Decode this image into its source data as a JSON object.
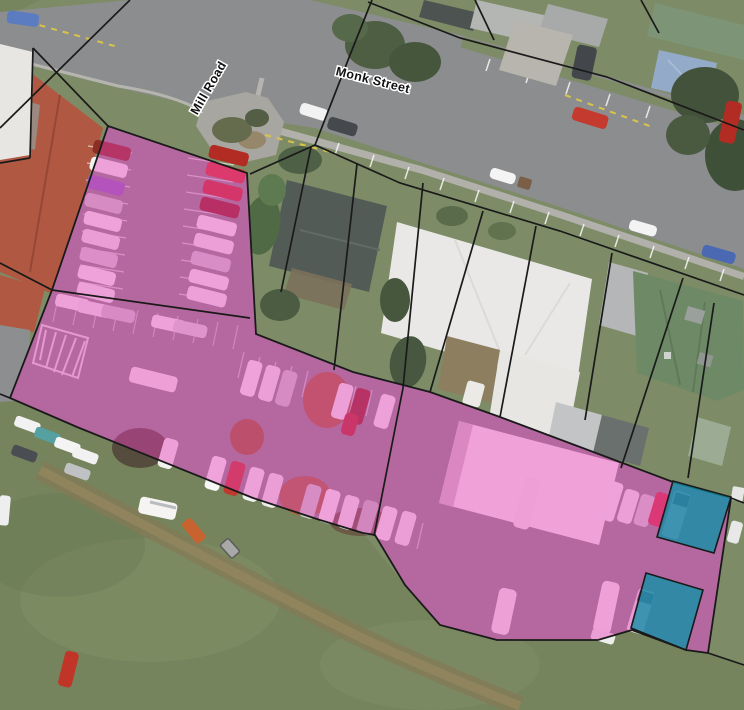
{
  "map": {
    "street_labels": [
      {
        "id": "mill-road",
        "text": "Mill Road"
      },
      {
        "id": "monk-street",
        "text": "Monk Street"
      }
    ],
    "overlay_colors": {
      "parcel_boundary": "#1a1a1a",
      "selection_pink": "#E93FB8",
      "selection_teal": "#0E91A8"
    }
  }
}
